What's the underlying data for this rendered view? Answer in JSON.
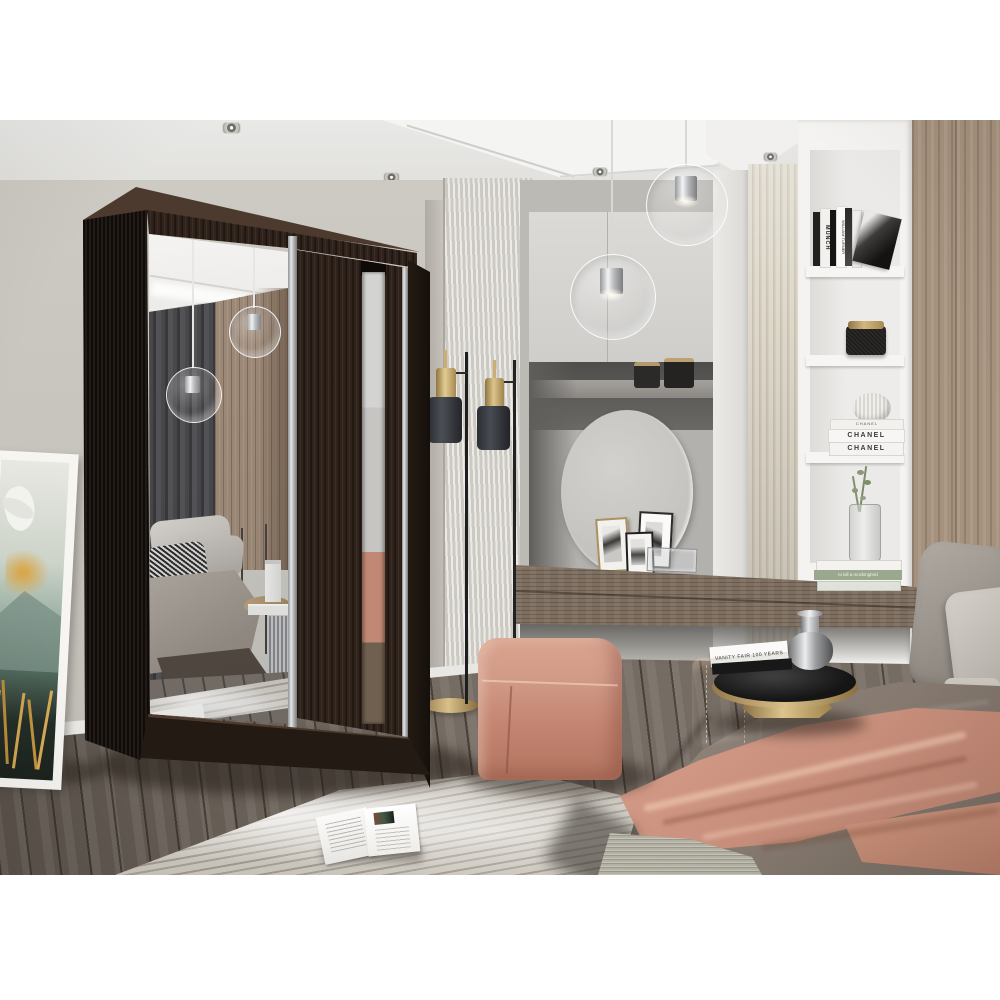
{
  "meta": {
    "description": "3D render photo: bedroom interior featuring a dark wenge two-door sliding wardrobe with mirrored door, vanity alcove with round mirror, white shelving, bed with salmon throw",
    "canvas": {
      "width": 1000,
      "height": 1000
    },
    "photo_area": {
      "left": 0,
      "top": 120,
      "right": 1000,
      "bottom": 875
    }
  },
  "palette": {
    "background": "#ffffff",
    "wall": "#c8c5be",
    "ceiling": "#e9e9e7",
    "wenge_dark": "#1b130f",
    "wenge_mid": "#30231c",
    "mirror_silver": "#c7c9ca",
    "wood_panel": "#a5917d",
    "fluted_panel": "#d6cfbf",
    "shelf_white": "#f4f3f1",
    "desk_wood": "#7d6e5f",
    "alcove_gray": "#5f5e5b",
    "cabinet_gray": "#d6d5d2",
    "pouf_salmon": "#c98d7a",
    "blanket_salmon": "#c88f7c",
    "duvet_taupe": "#8b7f75",
    "pillow_gray": "#a29c95",
    "floor_wood": "#756c63",
    "rug": "#ccc7be",
    "brass": "#b49a6a",
    "lamp_shade": "#3c3f44",
    "leather_basket": "#9a6a52",
    "art_teal": "#51695d",
    "art_gold": "#c79a45"
  },
  "texts": {
    "book_spine_munch": "MUNCH",
    "book_spine_turner": "WILLIAM TURNER",
    "book_chanel_small": "CHANEL",
    "book_chanel_1": "CHANEL",
    "book_chanel_2": "CHANEL",
    "book_mockingbird": "to kill a mockingbird",
    "book_vanity_fair": "VANITY FAIR 100 YEARS"
  },
  "objects": {
    "wardrobe": "two-door sliding wardrobe, wenge, left full mirror door, right door with mirror strip",
    "pendant_lights_count": 2,
    "ceiling_spotlights_count": 4,
    "floor_lamp": "double black-shade brass floor lamp",
    "artwork": "white-framed botanical artwork leaning against wall",
    "vanity": "wall-mounted wood vanity shelf with round mirror and photo frames",
    "shelving": "white built-in shelf unit with books, candle, vase",
    "pouf": "salmon cube pouf",
    "bed": "bed with taupe duvet, salmon throw, gray pillows",
    "side_table": "round black top side table with brass base, books and chrome vase",
    "rug": "marbled gray rug with open magazine",
    "basket": "cognac leather basket"
  }
}
